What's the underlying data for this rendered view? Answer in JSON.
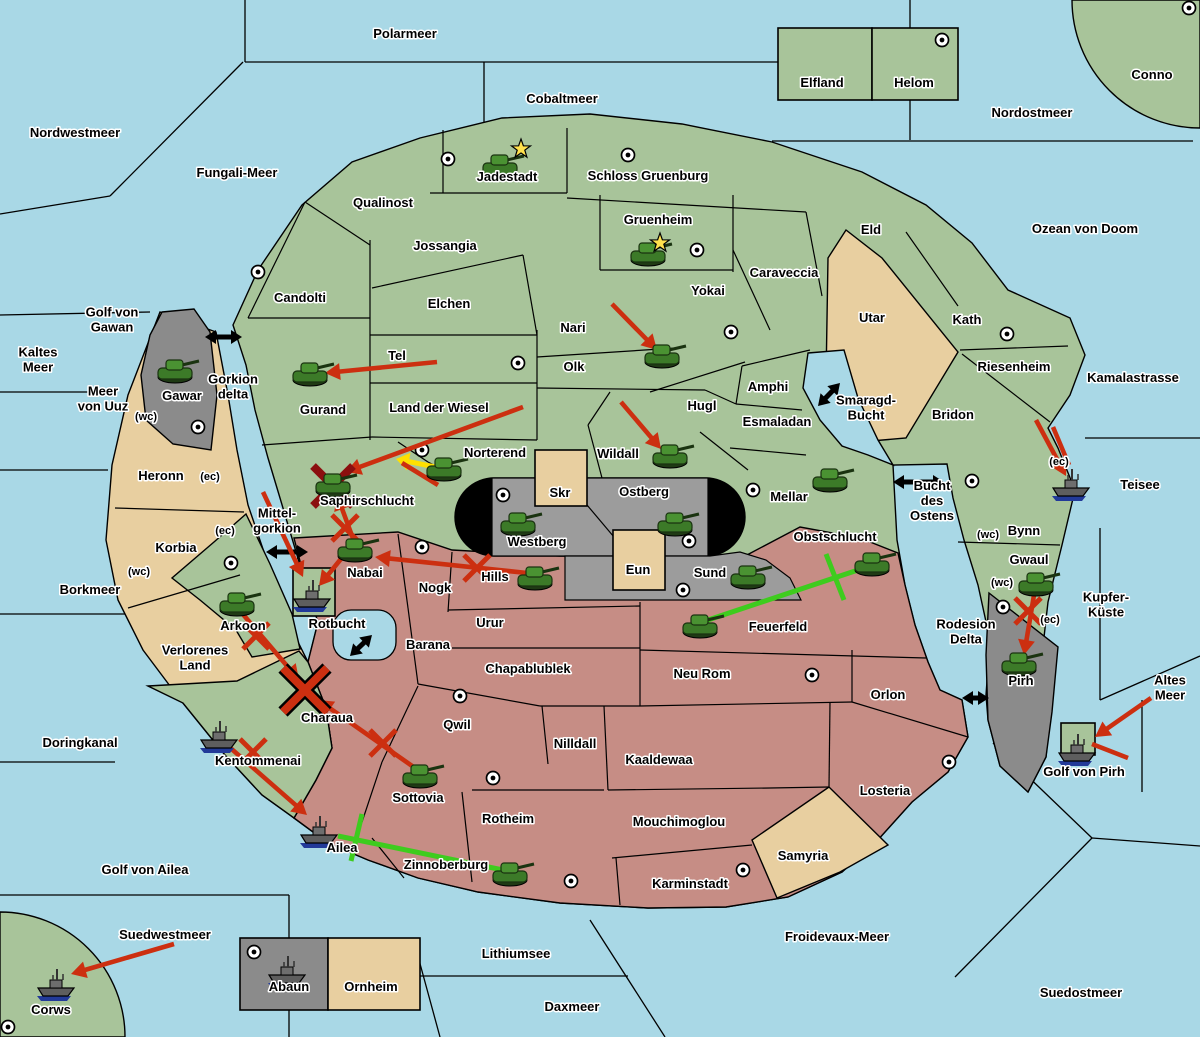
{
  "map": {
    "colors": {
      "sea": "#a9d8e6",
      "land_green": "#a8c49a",
      "land_tan": "#e8cfa0",
      "land_red": "#c68d85",
      "gray": "#8b8b8b",
      "stadium_gray": "#9c9c9c",
      "black_zone": "#000000",
      "attack_red": "#cc2f10",
      "support_green": "#3ecc1e",
      "convoy_yellow": "#ffe000",
      "dislodge_red": "#8b0f0f",
      "star_yellow": "#ffe14d"
    },
    "sea_labels": [
      {
        "lines": [
          "Polarmeer"
        ],
        "x": 405,
        "y": 38
      },
      {
        "lines": [
          "Cobaltmeer"
        ],
        "x": 562,
        "y": 103
      },
      {
        "lines": [
          "Nordostmeer"
        ],
        "x": 1032,
        "y": 117
      },
      {
        "lines": [
          "Nordwestmeer"
        ],
        "x": 75,
        "y": 137
      },
      {
        "lines": [
          "Fungali-Meer"
        ],
        "x": 237,
        "y": 177
      },
      {
        "lines": [
          "Ozean von Doom"
        ],
        "x": 1085,
        "y": 233
      },
      {
        "lines": [
          "Golf von",
          "Gawan"
        ],
        "x": 112,
        "y": 324
      },
      {
        "lines": [
          "Kaltes",
          "Meer"
        ],
        "x": 38,
        "y": 364
      },
      {
        "lines": [
          "Meer",
          "von Uuz"
        ],
        "x": 103,
        "y": 403
      },
      {
        "lines": [
          "Gorkion",
          "delta"
        ],
        "x": 233,
        "y": 391
      },
      {
        "lines": [
          "Mittel-",
          "gorkion"
        ],
        "x": 277,
        "y": 525
      },
      {
        "lines": [
          "Borkmeer"
        ],
        "x": 90,
        "y": 594
      },
      {
        "lines": [
          "Rotbucht"
        ],
        "x": 337,
        "y": 628
      },
      {
        "lines": [
          "Doringkanal"
        ],
        "x": 80,
        "y": 747
      },
      {
        "lines": [
          "Golf von Ailea"
        ],
        "x": 145,
        "y": 874
      },
      {
        "lines": [
          "Suedwestmeer"
        ],
        "x": 165,
        "y": 939
      },
      {
        "lines": [
          "Lithiumsee"
        ],
        "x": 516,
        "y": 958
      },
      {
        "lines": [
          "Daxmeer"
        ],
        "x": 572,
        "y": 1011
      },
      {
        "lines": [
          "Froidevaux-Meer"
        ],
        "x": 837,
        "y": 941
      },
      {
        "lines": [
          "Suedostmeer"
        ],
        "x": 1081,
        "y": 997
      },
      {
        "lines": [
          "Golf von Pirh"
        ],
        "x": 1084,
        "y": 776
      },
      {
        "lines": [
          "Altes",
          "Meer"
        ],
        "x": 1170,
        "y": 692
      },
      {
        "lines": [
          "Teisee"
        ],
        "x": 1140,
        "y": 489
      },
      {
        "lines": [
          "Kupfer-",
          "Küste"
        ],
        "x": 1106,
        "y": 609
      },
      {
        "lines": [
          "Bucht",
          "des",
          "Ostens"
        ],
        "x": 932,
        "y": 505
      },
      {
        "lines": [
          "Smaragd-",
          "Bucht"
        ],
        "x": 866,
        "y": 412
      },
      {
        "lines": [
          "Rodesion",
          "Delta"
        ],
        "x": 966,
        "y": 636
      },
      {
        "lines": [
          "Kamalastrasse"
        ],
        "x": 1133,
        "y": 382
      }
    ],
    "land_labels": [
      {
        "lines": [
          "Conno"
        ],
        "x": 1152,
        "y": 79
      },
      {
        "lines": [
          "Elfland"
        ],
        "x": 822,
        "y": 87
      },
      {
        "lines": [
          "Helom"
        ],
        "x": 914,
        "y": 87
      },
      {
        "lines": [
          "Qualinost"
        ],
        "x": 383,
        "y": 207
      },
      {
        "lines": [
          "Jadestadt"
        ],
        "x": 507,
        "y": 181
      },
      {
        "lines": [
          "Schloss Gruenburg"
        ],
        "x": 648,
        "y": 180
      },
      {
        "lines": [
          "Gruenheim"
        ],
        "x": 658,
        "y": 224
      },
      {
        "lines": [
          "Jossangia"
        ],
        "x": 445,
        "y": 250
      },
      {
        "lines": [
          "Eld"
        ],
        "x": 871,
        "y": 234
      },
      {
        "lines": [
          "Candolti"
        ],
        "x": 300,
        "y": 302
      },
      {
        "lines": [
          "Elchen"
        ],
        "x": 449,
        "y": 308
      },
      {
        "lines": [
          "Yokai"
        ],
        "x": 708,
        "y": 295
      },
      {
        "lines": [
          "Caraveccia"
        ],
        "x": 784,
        "y": 277
      },
      {
        "lines": [
          "Utar"
        ],
        "x": 872,
        "y": 322
      },
      {
        "lines": [
          "Kath"
        ],
        "x": 967,
        "y": 324
      },
      {
        "lines": [
          "Nari"
        ],
        "x": 573,
        "y": 332
      },
      {
        "lines": [
          "Tel"
        ],
        "x": 397,
        "y": 360
      },
      {
        "lines": [
          "Olk"
        ],
        "x": 574,
        "y": 371
      },
      {
        "lines": [
          "Riesenheim"
        ],
        "x": 1014,
        "y": 371
      },
      {
        "lines": [
          "Gurand"
        ],
        "x": 323,
        "y": 414
      },
      {
        "lines": [
          "Land der Wiesel"
        ],
        "x": 439,
        "y": 412
      },
      {
        "lines": [
          "Hugl"
        ],
        "x": 702,
        "y": 410
      },
      {
        "lines": [
          "Amphi"
        ],
        "x": 768,
        "y": 391
      },
      {
        "lines": [
          "Esmaladan"
        ],
        "x": 777,
        "y": 426
      },
      {
        "lines": [
          "Bridon"
        ],
        "x": 953,
        "y": 419
      },
      {
        "lines": [
          "Norterend"
        ],
        "x": 495,
        "y": 457
      },
      {
        "lines": [
          "Wildall"
        ],
        "x": 618,
        "y": 458
      },
      {
        "lines": [
          "Mellar"
        ],
        "x": 789,
        "y": 501
      },
      {
        "lines": [
          "Saphirschlucht"
        ],
        "x": 367,
        "y": 505
      },
      {
        "lines": [
          "Skr"
        ],
        "x": 560,
        "y": 497
      },
      {
        "lines": [
          "Ostberg"
        ],
        "x": 644,
        "y": 496
      },
      {
        "lines": [
          "Westberg"
        ],
        "x": 537,
        "y": 546
      },
      {
        "lines": [
          "Eun"
        ],
        "x": 638,
        "y": 574
      },
      {
        "lines": [
          "Sund"
        ],
        "x": 710,
        "y": 577
      },
      {
        "lines": [
          "Obstschlucht"
        ],
        "x": 835,
        "y": 541
      },
      {
        "lines": [
          "Bynn"
        ],
        "x": 1024,
        "y": 535
      },
      {
        "lines": [
          "Gwaul"
        ],
        "x": 1029,
        "y": 564
      },
      {
        "lines": [
          "Heronn"
        ],
        "x": 161,
        "y": 480
      },
      {
        "lines": [
          "Korbia"
        ],
        "x": 176,
        "y": 552
      },
      {
        "lines": [
          "Nabai"
        ],
        "x": 365,
        "y": 577
      },
      {
        "lines": [
          "Nogk"
        ],
        "x": 435,
        "y": 592
      },
      {
        "lines": [
          "Hills"
        ],
        "x": 495,
        "y": 581
      },
      {
        "lines": [
          "Arkoon"
        ],
        "x": 243,
        "y": 630
      },
      {
        "lines": [
          "Verlorenes",
          "Land"
        ],
        "x": 195,
        "y": 662
      },
      {
        "lines": [
          "Barana"
        ],
        "x": 428,
        "y": 649
      },
      {
        "lines": [
          "Urur"
        ],
        "x": 490,
        "y": 627
      },
      {
        "lines": [
          "Feuerfeld"
        ],
        "x": 778,
        "y": 631
      },
      {
        "lines": [
          "Chapablublek"
        ],
        "x": 528,
        "y": 673
      },
      {
        "lines": [
          "Neu Rom"
        ],
        "x": 702,
        "y": 678
      },
      {
        "lines": [
          "Orlon"
        ],
        "x": 888,
        "y": 699
      },
      {
        "lines": [
          "Pirh"
        ],
        "x": 1021,
        "y": 685
      },
      {
        "lines": [
          "Charaua"
        ],
        "x": 327,
        "y": 722
      },
      {
        "lines": [
          "Qwil"
        ],
        "x": 457,
        "y": 729
      },
      {
        "lines": [
          "Nilldall"
        ],
        "x": 575,
        "y": 748
      },
      {
        "lines": [
          "Kaaldewaa"
        ],
        "x": 659,
        "y": 764
      },
      {
        "lines": [
          "Kentommenai"
        ],
        "x": 258,
        "y": 765
      },
      {
        "lines": [
          "Sottovia"
        ],
        "x": 418,
        "y": 802
      },
      {
        "lines": [
          "Losteria"
        ],
        "x": 885,
        "y": 795
      },
      {
        "lines": [
          "Rotheim"
        ],
        "x": 508,
        "y": 823
      },
      {
        "lines": [
          "Mouchimoglou"
        ],
        "x": 679,
        "y": 826
      },
      {
        "lines": [
          "Ailea"
        ],
        "x": 342,
        "y": 852
      },
      {
        "lines": [
          "Zinnoberburg"
        ],
        "x": 446,
        "y": 869
      },
      {
        "lines": [
          "Samyria"
        ],
        "x": 803,
        "y": 860
      },
      {
        "lines": [
          "Karminstadt"
        ],
        "x": 690,
        "y": 888
      },
      {
        "lines": [
          "Gawar"
        ],
        "x": 182,
        "y": 400
      },
      {
        "lines": [
          "Abaun"
        ],
        "x": 289,
        "y": 991
      },
      {
        "lines": [
          "Ornheim"
        ],
        "x": 371,
        "y": 991
      },
      {
        "lines": [
          "Corws"
        ],
        "x": 51,
        "y": 1014
      }
    ],
    "coast_markers": [
      {
        "text": "(wc)",
        "x": 146,
        "y": 420
      },
      {
        "text": "(ec)",
        "x": 210,
        "y": 480
      },
      {
        "text": "(ec)",
        "x": 225,
        "y": 534
      },
      {
        "text": "(wc)",
        "x": 139,
        "y": 575
      },
      {
        "text": "(wc)",
        "x": 988,
        "y": 538
      },
      {
        "text": "(wc)",
        "x": 1002,
        "y": 586
      },
      {
        "text": "(ec)",
        "x": 1050,
        "y": 623
      },
      {
        "text": "(ec)",
        "x": 1059,
        "y": 465
      }
    ],
    "supply_centers": [
      [
        448,
        159
      ],
      [
        628,
        155
      ],
      [
        697,
        250
      ],
      [
        942,
        40
      ],
      [
        1189,
        8
      ],
      [
        258,
        272
      ],
      [
        518,
        363
      ],
      [
        1007,
        334
      ],
      [
        731,
        332
      ],
      [
        198,
        427
      ],
      [
        753,
        490
      ],
      [
        422,
        450
      ],
      [
        503,
        495
      ],
      [
        689,
        541
      ],
      [
        683,
        590
      ],
      [
        422,
        547
      ],
      [
        231,
        563
      ],
      [
        460,
        696
      ],
      [
        812,
        675
      ],
      [
        972,
        481
      ],
      [
        1003,
        607
      ],
      [
        949,
        762
      ],
      [
        743,
        870
      ],
      [
        571,
        881
      ],
      [
        493,
        778
      ],
      [
        254,
        952
      ],
      [
        8,
        1027
      ]
    ],
    "units": {
      "tanks": [
        {
          "x": 500,
          "y": 166,
          "loc": "jadestadt"
        },
        {
          "x": 648,
          "y": 254,
          "loc": "gruenheim"
        },
        {
          "x": 310,
          "y": 374,
          "loc": "gurand"
        },
        {
          "x": 662,
          "y": 356,
          "loc": "olk"
        },
        {
          "x": 175,
          "y": 371,
          "loc": "gawar"
        },
        {
          "x": 444,
          "y": 469,
          "loc": "norterend"
        },
        {
          "x": 670,
          "y": 456,
          "loc": "wildall"
        },
        {
          "x": 830,
          "y": 480,
          "loc": "mellar"
        },
        {
          "x": 333,
          "y": 485,
          "loc": "saphirschlucht"
        },
        {
          "x": 518,
          "y": 524,
          "loc": "westberg"
        },
        {
          "x": 675,
          "y": 524,
          "loc": "ostberg"
        },
        {
          "x": 355,
          "y": 550,
          "loc": "nabai"
        },
        {
          "x": 535,
          "y": 578,
          "loc": "hills"
        },
        {
          "x": 748,
          "y": 577,
          "loc": "sund"
        },
        {
          "x": 872,
          "y": 564,
          "loc": "obstschlucht"
        },
        {
          "x": 700,
          "y": 626,
          "loc": "feuerfeld"
        },
        {
          "x": 1036,
          "y": 584,
          "loc": "gwaul"
        },
        {
          "x": 1019,
          "y": 664,
          "loc": "pirh"
        },
        {
          "x": 420,
          "y": 776,
          "loc": "sottovia"
        },
        {
          "x": 510,
          "y": 874,
          "loc": "zinnoberburg"
        },
        {
          "x": 237,
          "y": 604,
          "loc": "arkoon"
        }
      ],
      "ships": [
        {
          "x": 1072,
          "y": 484,
          "loc": "bynn-coast"
        },
        {
          "x": 313,
          "y": 595,
          "loc": "rotbucht"
        },
        {
          "x": 220,
          "y": 736,
          "loc": "kentommenai"
        },
        {
          "x": 320,
          "y": 831,
          "loc": "ailea"
        },
        {
          "x": 1078,
          "y": 749,
          "loc": "golf-von-pirh"
        },
        {
          "x": 57,
          "y": 984,
          "loc": "corws"
        },
        {
          "x": 288,
          "y": 971,
          "loc": "abaun"
        }
      ],
      "stars": [
        [
          521,
          149
        ],
        [
          660,
          243
        ]
      ]
    },
    "orders": {
      "attack_arrows": [
        [
          437,
          362,
          325,
          373
        ],
        [
          612,
          304,
          657,
          350
        ],
        [
          621,
          402,
          661,
          449
        ],
        [
          523,
          407,
          346,
          472
        ],
        [
          355,
          544,
          337,
          495
        ],
        [
          527,
          573,
          375,
          557
        ],
        [
          263,
          492,
          303,
          577
        ],
        [
          349,
          549,
          319,
          586
        ],
        [
          241,
          612,
          299,
          680
        ],
        [
          415,
          768,
          318,
          700
        ],
        [
          227,
          745,
          307,
          815
        ],
        [
          1034,
          595,
          1024,
          655
        ],
        [
          1036,
          420,
          1066,
          476
        ],
        [
          1151,
          698,
          1095,
          737
        ],
        [
          174,
          944,
          71,
          974
        ]
      ],
      "extra_red_lines": [
        [
          1128,
          758,
          1092,
          744
        ],
        [
          1053,
          427,
          1069,
          465
        ],
        [
          438,
          485,
          402,
          463
        ]
      ],
      "support_lines": [
        {
          "line": [
            702,
            622,
            864,
            568
          ],
          "cut": [
            826,
            554,
            844,
            600
          ]
        },
        {
          "line": [
            503,
            870,
            338,
            836
          ],
          "cut": [
            362,
            814,
            351,
            861
          ]
        }
      ],
      "convoy_arrow": [
        450,
        470,
        396,
        459
      ],
      "fail_marks": [
        [
          345,
          528
        ],
        [
          477,
          568
        ],
        [
          256,
          636
        ],
        [
          383,
          743
        ],
        [
          253,
          752
        ],
        [
          1028,
          611
        ]
      ],
      "dislodged_mark": [
        333,
        486
      ],
      "big_battle_mark": [
        305,
        690
      ]
    },
    "strait_arrows": [
      [
        205,
        337,
        242,
        337
      ],
      [
        266,
        552,
        308,
        552
      ],
      [
        818,
        406,
        840,
        383
      ],
      [
        893,
        482,
        944,
        482
      ],
      [
        962,
        698,
        989,
        698
      ],
      [
        350,
        656,
        372,
        635
      ]
    ]
  }
}
